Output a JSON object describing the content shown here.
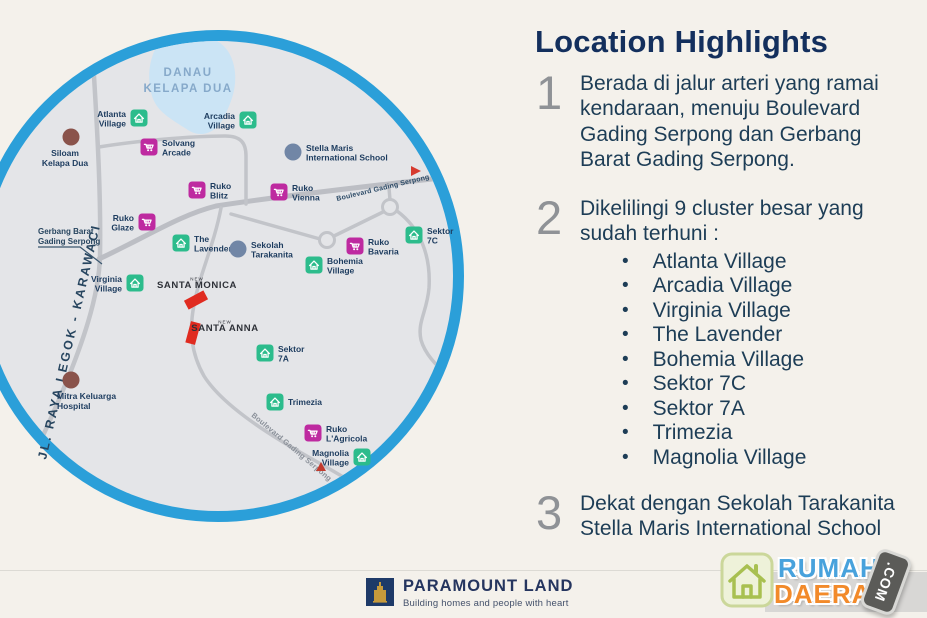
{
  "highlights": {
    "title": "Location Highlights",
    "items": [
      {
        "number": "1",
        "lines": [
          "Berada di jalur arteri yang ramai",
          "kendaraan, menuju  Boulevard",
          "Gading Serpong dan Gerbang",
          "Barat Gading Serpong."
        ]
      },
      {
        "number": "2",
        "lines": [
          "Dikelilingi 9 cluster besar yang",
          "sudah terhuni :"
        ],
        "bullet_char": "•",
        "bullets": [
          "Atlanta Village",
          "Arcadia Village",
          "Virginia Village",
          "The Lavender",
          "Bohemia Village",
          "Sektor 7C",
          "Sektor 7A",
          "Trimezia",
          "Magnolia Village"
        ]
      },
      {
        "number": "3",
        "lines": [
          "Dekat dengan Sekolah Tarakanita",
          "Stella Maris International School"
        ]
      }
    ]
  },
  "map": {
    "lake_label": [
      "DANAU",
      "KELAPA DUA"
    ],
    "road_labels": {
      "jl_raya": "JL. RAYA LEGOK - KARAWACI",
      "boulevard_top": "Boulevard Gading Serpong",
      "boulevard_bottom": "Boulevard Gading Serpong",
      "gerbang": [
        "Gerbang Barat",
        "Gading Serpong"
      ]
    },
    "colors": {
      "ring": "#2B9FD9",
      "land": "#E4E5E8",
      "lake": "#CBE4F5",
      "road": "#C2C4C9",
      "village": "#2CBC8C",
      "ruko": "#BE2AA0",
      "school": "#7186A6",
      "hospital": "#8A534B",
      "project_red": "#E02B20"
    },
    "pois": [
      {
        "id": "atlanta-village",
        "type": "village",
        "x": 139,
        "y": 118,
        "side": "left",
        "lines": [
          "Atlanta",
          "Village"
        ]
      },
      {
        "id": "arcadia-village",
        "type": "village",
        "x": 248,
        "y": 120,
        "side": "left",
        "lines": [
          "Arcadia",
          "Village"
        ]
      },
      {
        "id": "siloam-kelapa-dua",
        "type": "hospital",
        "x": 71,
        "y": 137,
        "side": "below",
        "lines": [
          "Siloam",
          "Kelapa Dua"
        ]
      },
      {
        "id": "solvang-arcade",
        "type": "ruko",
        "x": 149,
        "y": 147,
        "side": "right",
        "lines": [
          "Solvang",
          "Arcade"
        ]
      },
      {
        "id": "stella-maris-international-school",
        "type": "school",
        "x": 293,
        "y": 152,
        "side": "right",
        "lines": [
          "Stella Maris",
          "International School"
        ]
      },
      {
        "id": "ruko-blitz",
        "type": "ruko",
        "x": 197,
        "y": 190,
        "side": "right",
        "lines": [
          "Ruko",
          "Blitz"
        ]
      },
      {
        "id": "ruko-vienna",
        "type": "ruko",
        "x": 279,
        "y": 192,
        "side": "right",
        "lines": [
          "Ruko",
          "Vienna"
        ]
      },
      {
        "id": "ruko-glaze",
        "type": "ruko",
        "x": 147,
        "y": 222,
        "side": "left",
        "lines": [
          "Ruko",
          "Glaze"
        ]
      },
      {
        "id": "the-lavender",
        "type": "village",
        "x": 181,
        "y": 243,
        "side": "right",
        "lines": [
          "The",
          "Lavender"
        ]
      },
      {
        "id": "sekolah-tarakanita",
        "type": "school",
        "x": 238,
        "y": 249,
        "side": "right",
        "lines": [
          "Sekolah",
          "Tarakanita"
        ]
      },
      {
        "id": "ruko-bavaria",
        "type": "ruko",
        "x": 355,
        "y": 246,
        "side": "right",
        "lines": [
          "Ruko",
          "Bavaria"
        ]
      },
      {
        "id": "sektor-7c",
        "type": "village",
        "x": 414,
        "y": 235,
        "side": "right",
        "lines": [
          "Sektor",
          "7C"
        ]
      },
      {
        "id": "bohemia-village",
        "type": "village",
        "x": 314,
        "y": 265,
        "side": "right",
        "lines": [
          "Bohemia",
          "Village"
        ]
      },
      {
        "id": "virginia-village",
        "type": "village",
        "x": 135,
        "y": 283,
        "side": "left",
        "lines": [
          "Virginia",
          "Village"
        ]
      },
      {
        "id": "sektor-7a",
        "type": "village",
        "x": 265,
        "y": 353,
        "side": "right",
        "lines": [
          "Sektor",
          "7A"
        ]
      },
      {
        "id": "trimezia",
        "type": "village",
        "x": 275,
        "y": 402,
        "side": "right",
        "lines": [
          "Trimezia"
        ]
      },
      {
        "id": "ruko-l-agricola",
        "type": "ruko",
        "x": 313,
        "y": 433,
        "side": "right",
        "lines": [
          "Ruko",
          "L'Agricola"
        ]
      },
      {
        "id": "magnolia-village",
        "type": "village",
        "x": 362,
        "y": 457,
        "side": "left",
        "lines": [
          "Magnolia",
          "Village"
        ]
      },
      {
        "id": "mitra-keluarga-hospital",
        "type": "hospital",
        "x": 71,
        "y": 380,
        "side": "below-left",
        "lines": [
          "Mitra Keluarga",
          "Hospital"
        ]
      }
    ],
    "projects": [
      {
        "id": "santa-monica",
        "new_label": "NEW",
        "name": "SANTA MONICA",
        "tx": 197,
        "ty": 288,
        "rect": {
          "cx": 196,
          "cy": 300,
          "w": 22,
          "h": 10,
          "angle": -28
        }
      },
      {
        "id": "santa-anna",
        "new_label": "NEW",
        "name": "SANTA ANNA",
        "tx": 225,
        "ty": 331,
        "rect": {
          "cx": 193,
          "cy": 333,
          "w": 10,
          "h": 22,
          "angle": 15
        }
      }
    ]
  },
  "footer": {
    "brand": "PARAMOUNT LAND",
    "tagline": "Building homes and people with heart"
  },
  "watermark": {
    "word1": "RUMAH",
    "word2": "DAERAH",
    "badge": ".COM"
  }
}
